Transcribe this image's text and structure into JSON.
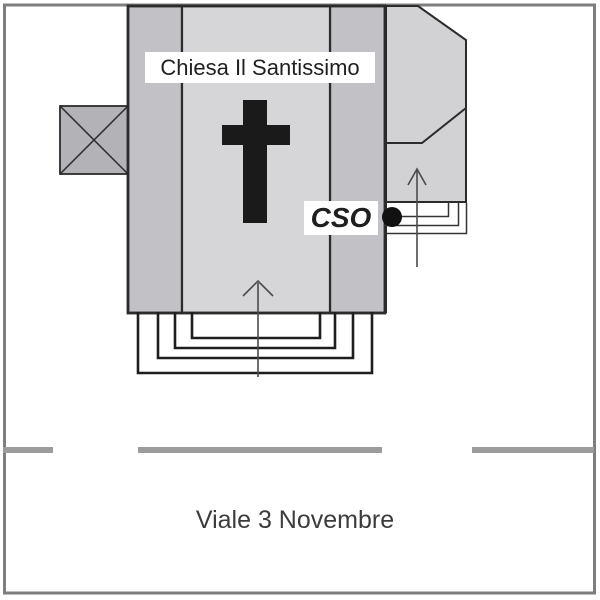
{
  "labels": {
    "church_name": "Chiesa Il Santissimo",
    "cso": "CSO",
    "street_name": "Viale 3 Novembre"
  },
  "map": {
    "colors": {
      "nave_fill": "#d6d6d8",
      "aisle_fill": "#c2c2c6",
      "annex_fill": "#d2d2d5",
      "tower_fill": "#b3b3b7",
      "outline": "#2b2b2b",
      "frame": "#7e7e7e",
      "street_dash": "#9c9c9c",
      "cross": "#1a1a1a",
      "marker_dot": "#111111",
      "arrow": "#4a4a4a"
    }
  }
}
